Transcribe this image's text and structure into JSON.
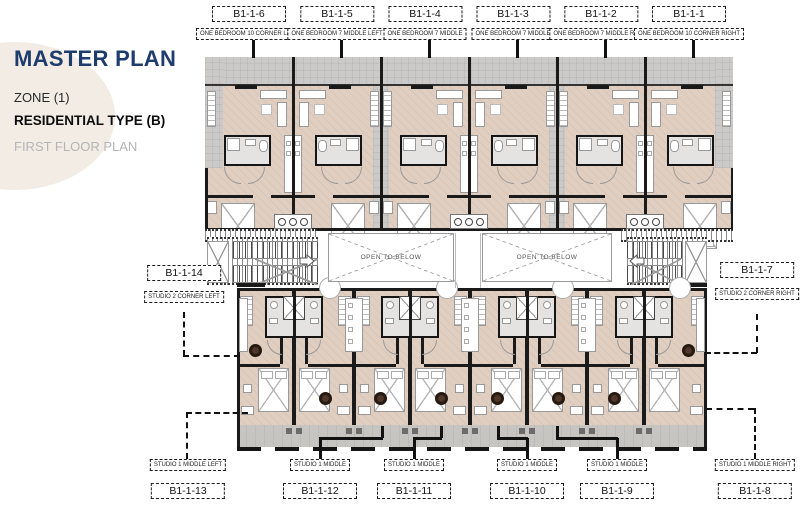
{
  "colors": {
    "accent_navy": "#1e3c6e",
    "floor_beige": "#e0cfc0",
    "terrace_gray": "#cbcac8",
    "balcony_gray": "#c7c5c2",
    "wall_black": "#1a1a1a",
    "table_brown": "#4e372a",
    "blob_cream": "#f2ece4",
    "muted_text": "#b5b5b5"
  },
  "title_block": {
    "title": "MASTER PLAN",
    "zone": "ZONE (1)",
    "residential_type": "RESIDENTIAL TYPE (B)",
    "floor": "FIRST FLOOR PLAN"
  },
  "top_units": [
    {
      "code": "B1-1-6",
      "type": "ONE BEDROOM 10 CORNER LEFT"
    },
    {
      "code": "B1-1-5",
      "type": "ONE BEDROOM 7 MIDDLE LEFT"
    },
    {
      "code": "B1-1-4",
      "type": "ONE BEDROOM 7 MIDDLE"
    },
    {
      "code": "B1-1-3",
      "type": "ONE BEDROOM 7 MIDDLE"
    },
    {
      "code": "B1-1-2",
      "type": "ONE BEDROOM 7 MIDDLE RIGHT"
    },
    {
      "code": "B1-1-1",
      "type": "ONE BEDROOM 10 CORNER RIGHT"
    }
  ],
  "mid_units": {
    "left": {
      "code": "B1-1-14",
      "type": "STUDIO 2 CORNER LEFT"
    },
    "right": {
      "code": "B1-1-7",
      "type": "STUDIO 2 CORNER RIGHT"
    }
  },
  "bottom_units": [
    {
      "code": "B1-1-13",
      "type": "STUDIO 1 MIDDLE LEFT"
    },
    {
      "code": "B1-1-12",
      "type": "STUDIO 1 MIDDLE"
    },
    {
      "code": "B1-1-11",
      "type": "STUDIO 1 MIDDLE"
    },
    {
      "code": "B1-1-10",
      "type": "STUDIO 1 MIDDLE"
    },
    {
      "code": "B1-1-9",
      "type": "STUDIO 1 MIDDLE"
    },
    {
      "code": "B1-1-8",
      "type": "STUDIO 1 MIDDLE RIGHT"
    }
  ],
  "open_to_below": {
    "label": "OPEN TO BELOW"
  }
}
